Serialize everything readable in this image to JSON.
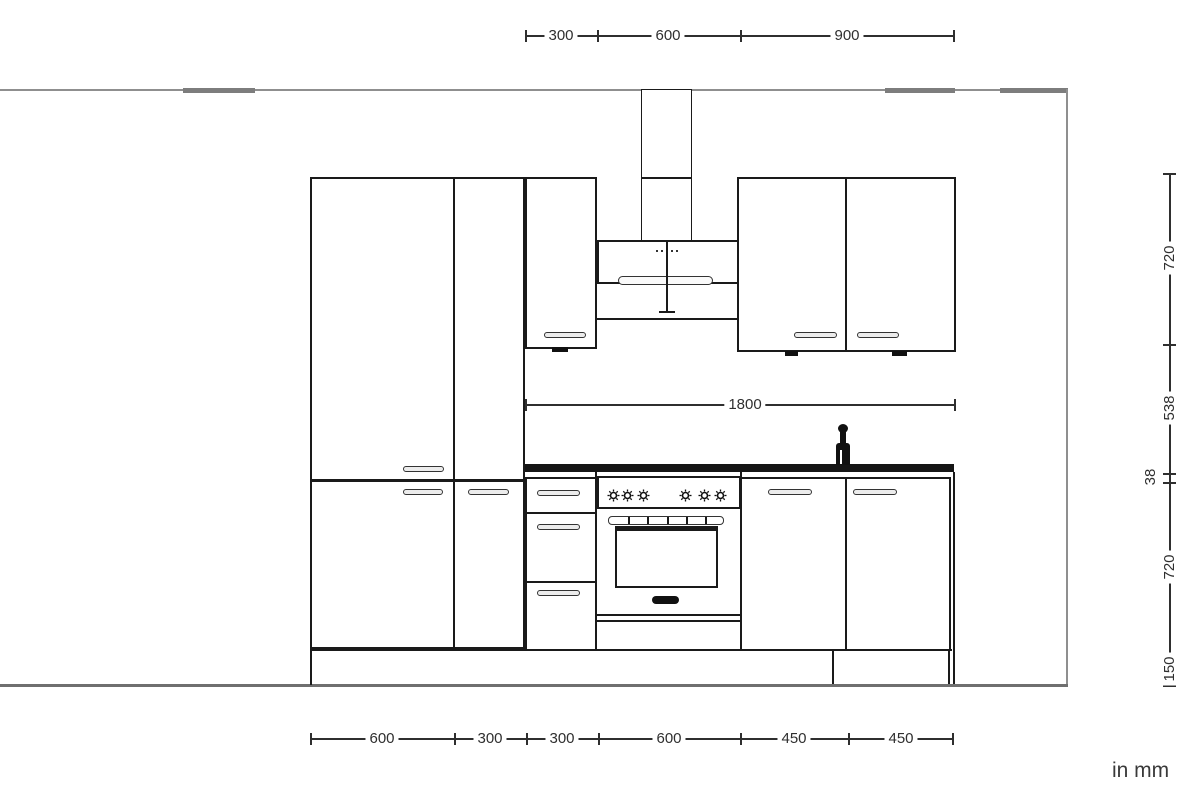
{
  "drawing": {
    "unit_note": "in mm",
    "dimensions_mm": {
      "top": [
        "300",
        "600",
        "900"
      ],
      "middle": "1800",
      "right": [
        "720",
        "538",
        "38",
        "720",
        "150"
      ],
      "bottom": [
        "600",
        "300",
        "300",
        "600",
        "450",
        "450"
      ]
    },
    "fixtures": {
      "hood_control_dot_count": 5,
      "range_knob_count": 6
    },
    "colors": {
      "background": "#ffffff",
      "cabinet_line": "#1a1a1a",
      "dimension_line": "#2f2f2f",
      "room_line": "#8f8f8f",
      "countertop": "#151515",
      "handle_fill": "#ececec"
    }
  }
}
